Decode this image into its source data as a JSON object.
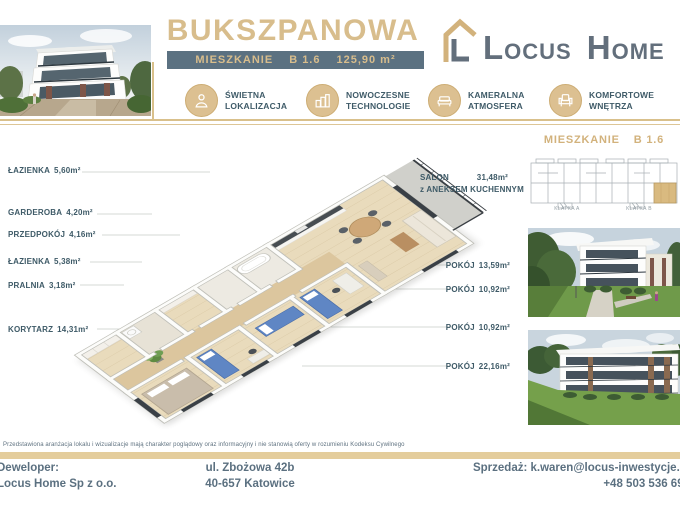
{
  "header": {
    "title": "BUKSZPANOWA",
    "badge": {
      "label": "MIESZKANIE",
      "unit": "B 1.6",
      "area": "125,90 m²"
    },
    "logo": {
      "locus": "Locus",
      "home": "Home"
    },
    "features": [
      {
        "line1": "ŚWIETNA",
        "line2": "LOKALIZACJA"
      },
      {
        "line1": "NOWOCZESNE",
        "line2": "TECHNOLOGIE"
      },
      {
        "line1": "KAMERALNA",
        "line2": "ATMOSFERA"
      },
      {
        "line1": "KOMFORTOWE",
        "line2": "WNĘTRZA"
      }
    ]
  },
  "plan": {
    "left_rooms": [
      {
        "name": "ŁAZIENKA",
        "area": "5,60m²"
      },
      {
        "name": "GARDEROBA",
        "area": "4,20m²"
      },
      {
        "name": "PRZEDPOKÓJ",
        "area": "4,16m²"
      },
      {
        "name": "ŁAZIENKA",
        "area": "5,38m²"
      },
      {
        "name": "PRALNIA",
        "area": "3,18m²"
      },
      {
        "name": "KORYTARZ",
        "area": "14,31m²"
      }
    ],
    "salon": {
      "name": "SALON",
      "area": "31,48m²",
      "annex": "z ANEKSEM KUCHENNYM"
    },
    "right_rooms": [
      {
        "name": "POKÓJ",
        "area": "13,59m²"
      },
      {
        "name": "POKÓJ",
        "area": "10,92m²"
      },
      {
        "name": "POKÓJ",
        "area": "10,92m²"
      },
      {
        "name": "POKÓJ",
        "area": "22,16m²"
      }
    ]
  },
  "sidebar": {
    "title_label": "MIESZKANIE",
    "title_unit": "B 1.6",
    "stairwell_a": "KLATKA A",
    "stairwell_b": "KLATKA B"
  },
  "disclaimer": "Przedstawiona aranżacja lokalu i wizualizacje mają charakter poglądowy oraz informacyjny i nie stanowią oferty w rozumieniu Kodeksu Cywilnego",
  "footer": {
    "developer_label": "Deweloper:",
    "developer_name": "Locus Home Sp z o.o.",
    "address_line1": "ul. Zbożowa 42b",
    "address_line2": "40-657 Katowice",
    "sales_contact": "Sprzedaż: k.waren@locus-inwestycje.pl",
    "sales_phone": "+48 503 536 699"
  },
  "colors": {
    "tan": "#d8bd8c",
    "slate_badge": "#5b7181",
    "text_dark": "#3f5b68",
    "logo_gray": "#636f7c"
  }
}
